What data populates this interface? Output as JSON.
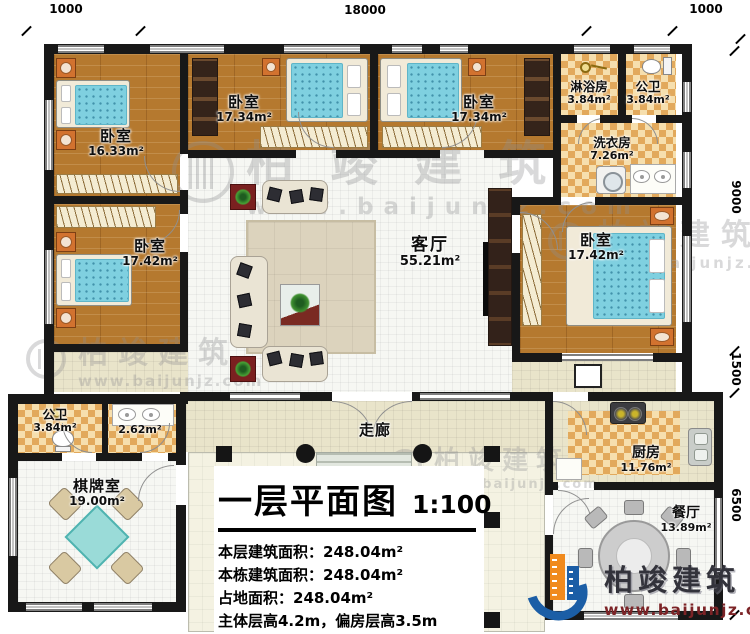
{
  "colors": {
    "wall": "#181818",
    "wood_floor": "#b5792f",
    "checker_dark": "#e2a95c",
    "checker_light": "#f6dfae",
    "living_tile": "#f6f7f3",
    "walkway_tile": "#e9e4ca",
    "mattress_blue": "#7fd0e0",
    "logo_blue": "#1b5ea6",
    "logo_orange": "#f08a1d",
    "logo_url_red": "#7c2326"
  },
  "dimensions": {
    "top": [
      "1000",
      "18000",
      "1000"
    ],
    "right": [
      "9000",
      "1500",
      "6500"
    ]
  },
  "rooms": [
    {
      "name": "卧室",
      "area": "16.33m²"
    },
    {
      "name": "卧室",
      "area": "17.34m²"
    },
    {
      "name": "卧室",
      "area": "17.34m²"
    },
    {
      "name": "淋浴房",
      "area": "3.84m²"
    },
    {
      "name": "公卫",
      "area": "3.84m²"
    },
    {
      "name": "洗衣房",
      "area": "7.26m²"
    },
    {
      "name": "卧室",
      "area": "17.42m²"
    },
    {
      "name": "客厅",
      "area": "55.21m²"
    },
    {
      "name": "卧室",
      "area": "17.42m²"
    },
    {
      "name": "公卫",
      "area": "3.84m²"
    },
    {
      "name": "",
      "area": "2.62m²"
    },
    {
      "name": "棋牌室",
      "area": "19.00m²"
    },
    {
      "name": "走廊",
      "area": ""
    },
    {
      "name": "厨房",
      "area": "11.76m²"
    },
    {
      "name": "餐厅",
      "area": "13.89m²"
    }
  ],
  "title_block": {
    "title": "一层平面图",
    "scale": "1:100",
    "stats": [
      "本层建筑面积：248.04m²",
      "本栋建筑面积：248.04m²",
      "占地面积：248.04m²",
      "主体层高4.2m，偏房层高3.5m"
    ]
  },
  "branding": {
    "logo_name": "柏竣建筑",
    "logo_url": "www.baijunjz.com",
    "watermark_name": "柏竣建筑",
    "watermark_url": "www.baijunjz.com"
  }
}
